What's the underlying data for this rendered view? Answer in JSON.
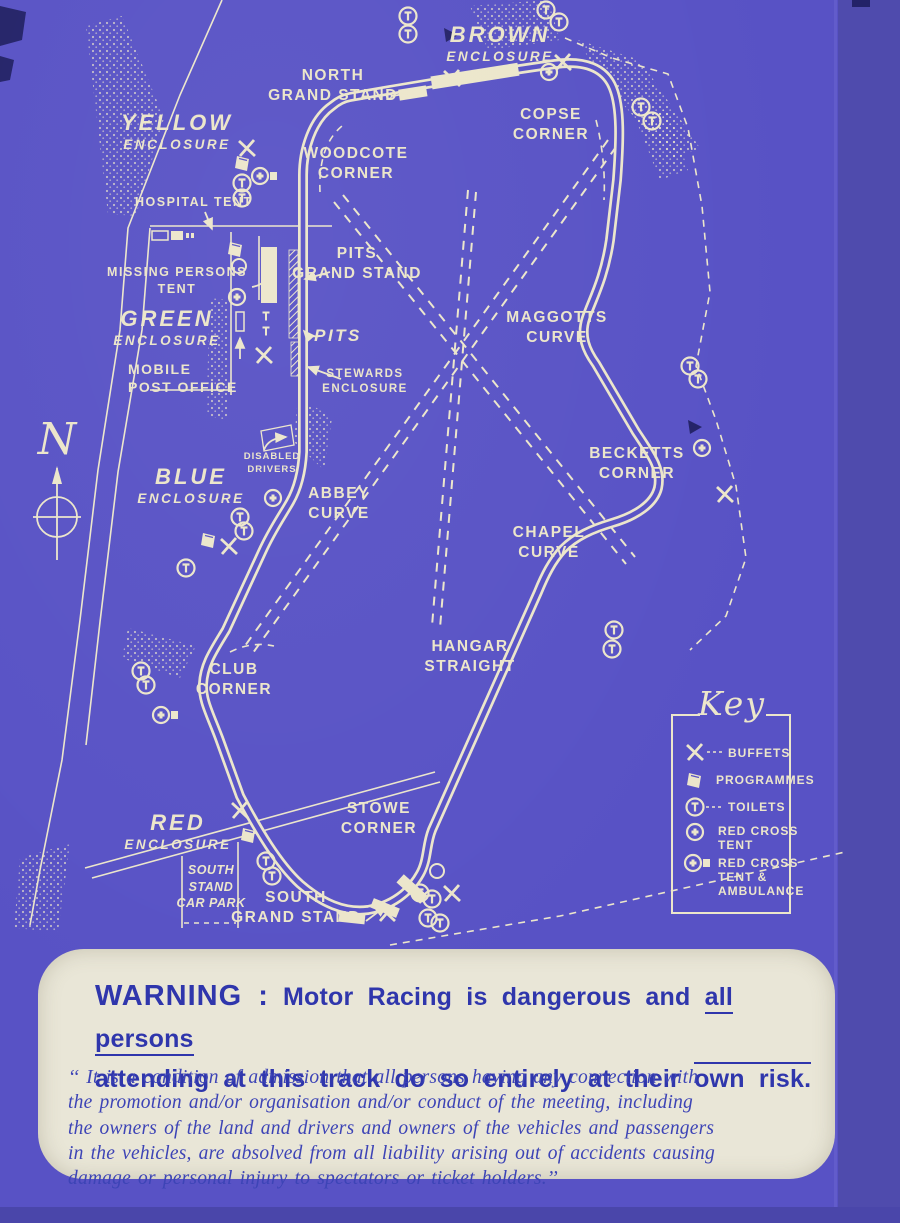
{
  "colors": {
    "background": "#5852c5",
    "ink": "#ece6cb",
    "dark": "#232268",
    "panel": "#e9e6d7",
    "panel_text": "#2f36ac"
  },
  "map": {
    "compass_letter": "N",
    "enclosures": {
      "brown": {
        "name": "BROWN",
        "type": "ENCLOSURE"
      },
      "yellow": {
        "name": "YELLOW",
        "type": "ENCLOSURE"
      },
      "green": {
        "name": "GREEN",
        "type": "ENCLOSURE"
      },
      "blue": {
        "name": "BLUE",
        "type": "ENCLOSURE"
      },
      "red": {
        "name": "RED",
        "type": "ENCLOSURE"
      }
    },
    "labels": {
      "north_grand_stand": "NORTH\nGRAND STAND",
      "copse_corner": "COPSE\nCORNER",
      "woodcote_corner": "WOODCOTE\nCORNER",
      "hospital_tent": "HOSPITAL TENT",
      "missing_persons_tent": "MISSING PERSONS\nTENT",
      "pits_grand_stand": "PITS\nGRAND STAND",
      "pits": "PITS",
      "mobile_post_office": "MOBILE\nPOST OFFICE",
      "stewards_enclosure": "STEWARDS\nENCLOSURE",
      "disabled_drivers": "DISABLED\nDRIVERS",
      "maggotts_curve": "MAGGOTTS\nCURVE",
      "becketts_corner": "BECKETTS\nCORNER",
      "abbey_curve": "ABBEY\nCURVE",
      "chapel_curve": "CHAPEL\nCURVE",
      "hangar_straight": "HANGAR\nSTRAIGHT",
      "club_corner": "CLUB\nCORNER",
      "stowe_corner": "STOWE\nCORNER",
      "south_stand_car_park": "SOUTH\nSTAND\nCAR PARK",
      "south_grand_stand": "SOUTH\nGRAND STAND"
    },
    "key": {
      "title": "Key",
      "items": [
        {
          "icon": "buffet-icon",
          "label": "BUFFETS"
        },
        {
          "icon": "programmes-icon",
          "label": "PROGRAMMES"
        },
        {
          "icon": "toilets-icon",
          "label": "TOILETS"
        },
        {
          "icon": "red-cross-tent-icon",
          "label": "RED CROSS\nTENT"
        },
        {
          "icon": "red-cross-tent-ambulance-icon",
          "label": "RED CROSS\nTENT &\nAMBULANCE"
        }
      ]
    }
  },
  "warning": {
    "heading_label": "WARNING :",
    "heading_rest_1": "Motor Racing is dangerous and",
    "heading_underlined": "all persons",
    "heading_rest_2": "attending at this track do so entirely at their",
    "heading_overlined": "own risk.",
    "body": "‘‘ It is a condition of admission that all persons having any connection with\nthe promotion and/or organisation and/or conduct of the meeting, including\nthe owners of the land and drivers and owners of the vehicles and passengers\nin the vehicles, are absolved from all liability arising out of accidents causing\ndamage or personal injury to spectators or ticket holders.’’"
  }
}
